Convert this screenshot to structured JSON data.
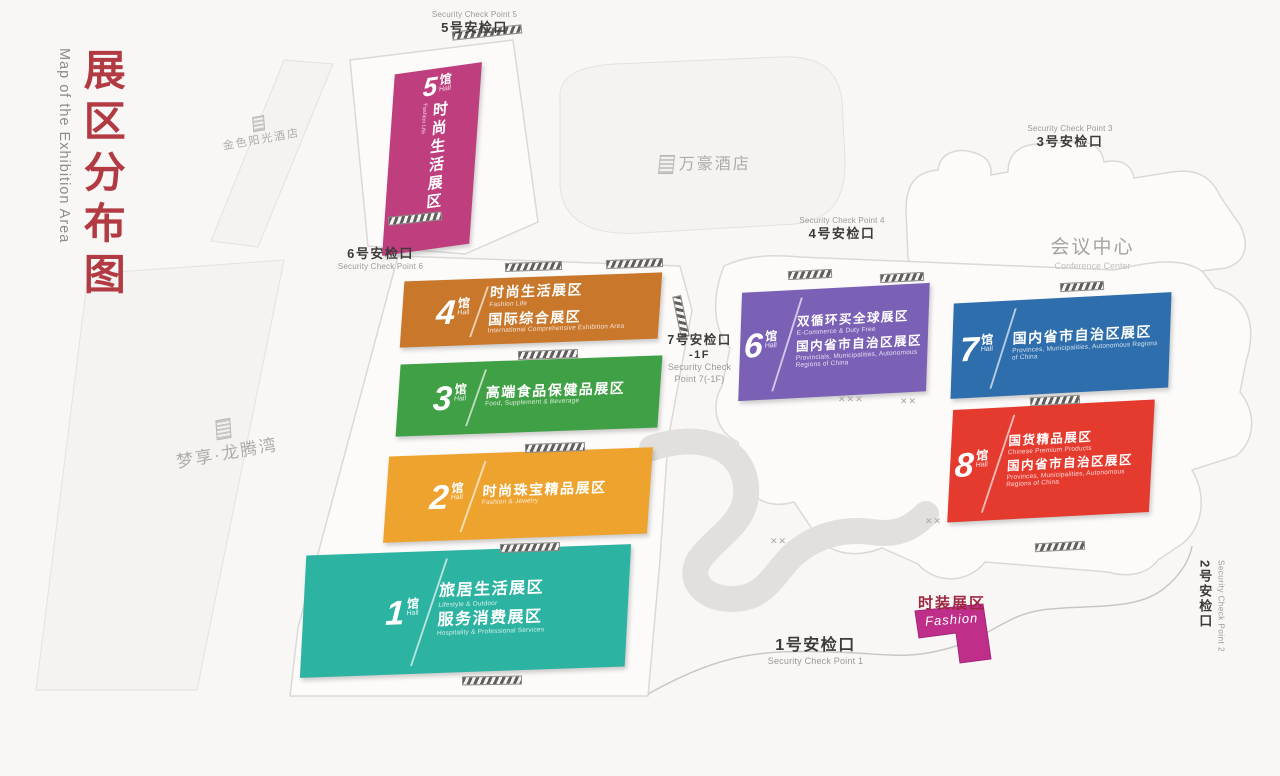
{
  "title": {
    "zh": "展区分布图",
    "en": "Map of the Exhibition Area"
  },
  "colors": {
    "title_red": "#b23a42",
    "hall1": "#2db3a2",
    "hall2": "#eea32e",
    "hall3": "#3fa045",
    "hall4": "#c8772b",
    "hall5": "#bf3e7d",
    "hall6": "#7a61b6",
    "hall7": "#2e6ead",
    "hall8": "#e53b2f",
    "fashion": "#bf2e88"
  },
  "halls": {
    "h1": {
      "num": "1",
      "unit": "馆",
      "unit_en": "Hall",
      "line1_zh": "旅居生活展区",
      "line1_en": "Lifestyle & Outdoor",
      "line2_zh": "服务消费展区",
      "line2_en": "Hospitality & Professional Services"
    },
    "h2": {
      "num": "2",
      "unit": "馆",
      "unit_en": "Hall",
      "line1_zh": "时尚珠宝精品展区",
      "line1_en": "Fashion & Jewelry"
    },
    "h3": {
      "num": "3",
      "unit": "馆",
      "unit_en": "Hall",
      "line1_zh": "高端食品保健品展区",
      "line1_en": "Food, Supplement & Beverage"
    },
    "h4": {
      "num": "4",
      "unit": "馆",
      "unit_en": "Hall",
      "line1_zh": "时尚生活展区",
      "line1_en": "Fashion Life",
      "line2_zh": "国际综合展区",
      "line2_en": "International Comprehensive Exhibition Area"
    },
    "h5": {
      "num": "5",
      "unit": "馆",
      "unit_en": "Hall",
      "line1_zh": "时尚生活展区",
      "line1_en": "Fashion Life"
    },
    "h6": {
      "num": "6",
      "unit": "馆",
      "unit_en": "Hall",
      "line1_zh": "双循环买全球展区",
      "line1_en": "E-Commerce & Duty Free",
      "line2_zh": "国内省市自治区展区",
      "line2_en": "Provincials, Municipalities, Autonomous Regions of China"
    },
    "h7": {
      "num": "7",
      "unit": "馆",
      "unit_en": "Hall",
      "line1_zh": "国内省市自治区展区",
      "line1_en": "Provinces, Municipalities, Autonomous Regions of China"
    },
    "h8": {
      "num": "8",
      "unit": "馆",
      "unit_en": "Hall",
      "line1_zh": "国货精品展区",
      "line1_en": "Chinese Premium Products",
      "line2_zh": "国内省市自治区展区",
      "line2_en": "Provinces, Municipalities, Autonomous Regions of China"
    }
  },
  "checkpoints": {
    "cp1": {
      "zh": "1号安检口",
      "en": "Security Check Point 1"
    },
    "cp2": {
      "zh": "2号安检口",
      "en": "Security Check Point 2"
    },
    "cp3": {
      "zh": "3号安检口",
      "en": "Security Check Point 3"
    },
    "cp4": {
      "zh": "4号安检口",
      "en": "Security Check Point 4"
    },
    "cp5": {
      "zh": "5号安检口",
      "en": "Security Check Point 5"
    },
    "cp6": {
      "zh": "6号安检口",
      "en": "Security Check Point 6"
    },
    "cp7": {
      "zh": "7号安检口",
      "floor": "-1F",
      "en_line1": "Security Check",
      "en_line2": "Point 7(-1F)"
    }
  },
  "buildings": {
    "golden_sunshine": {
      "zh": "金色阳光酒店"
    },
    "marriott": {
      "zh": "万豪酒店"
    },
    "dream_bay": {
      "zh": "梦享·龙腾湾"
    },
    "conference": {
      "zh": "会议中心",
      "en": "Conference Center"
    }
  },
  "fashion_zone": {
    "zh": "时装展区",
    "en": "Fashion"
  }
}
